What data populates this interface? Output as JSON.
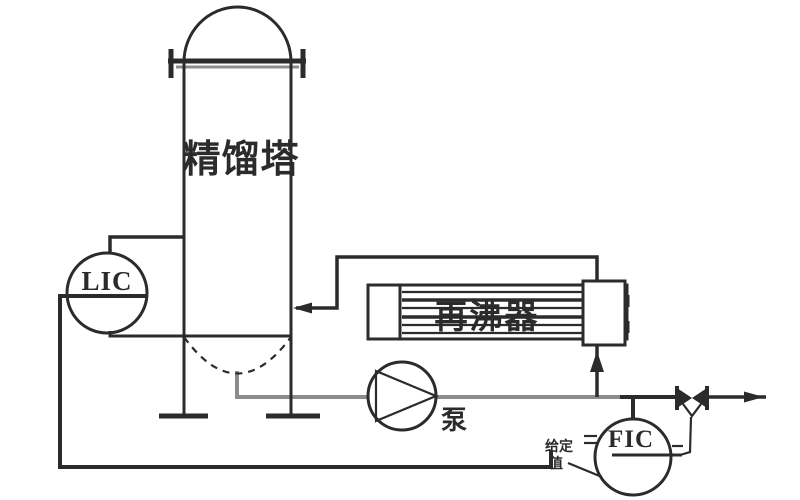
{
  "diagram": {
    "type": "process-control-diagram",
    "equipment_labels": {
      "column": "精馏塔",
      "reboiler": "再沸器",
      "pump": "泵"
    },
    "instrument_labels": {
      "level_controller": "LIC",
      "flow_controller": "FIC"
    },
    "annotations": {
      "setpoint_line1": "给定",
      "setpoint_line2": "值"
    },
    "colors": {
      "ink": "#2b2b2b",
      "ink_gray": "#8c8c8c",
      "background": "#ffffff"
    }
  }
}
